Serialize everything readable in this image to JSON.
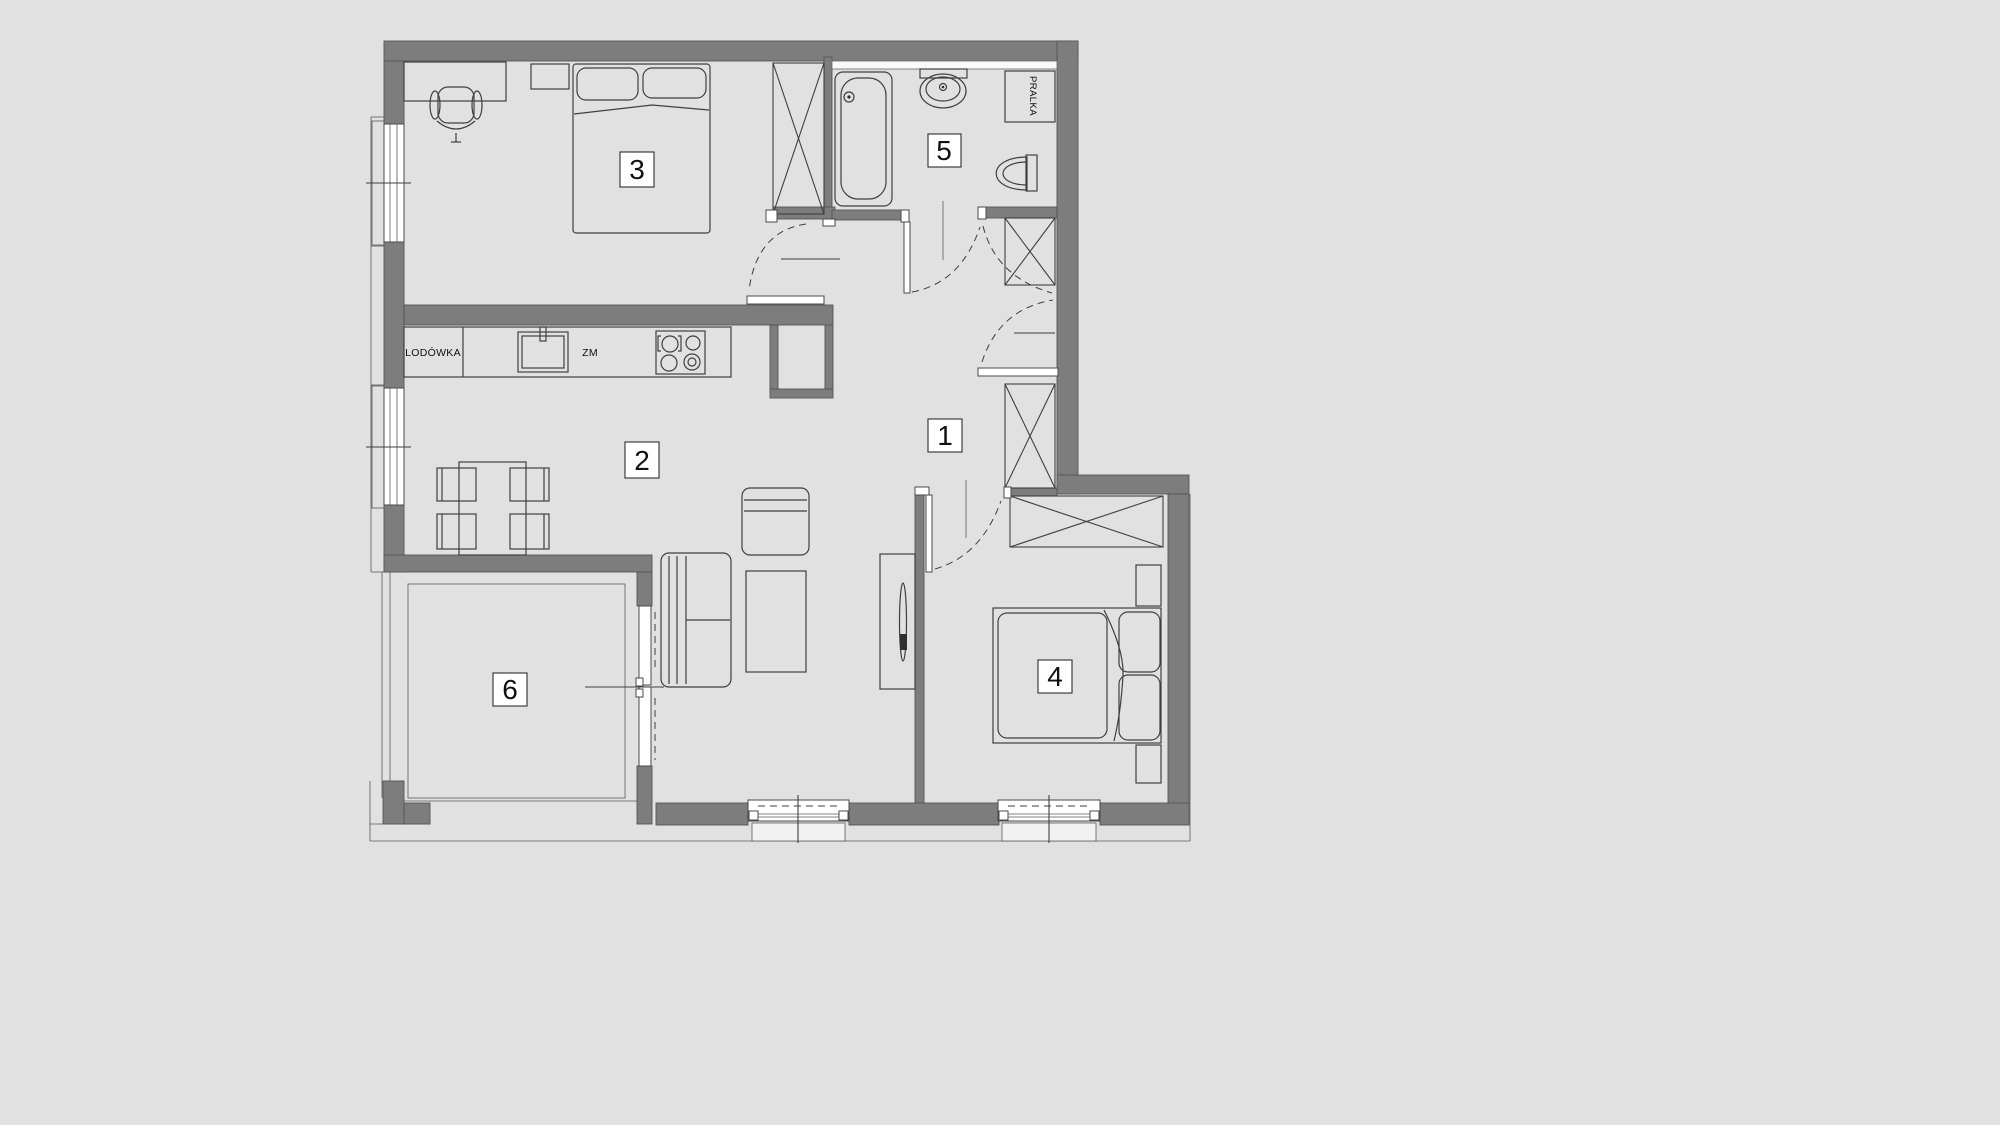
{
  "title": "Apartment floor plan",
  "rooms": [
    {
      "number": "1"
    },
    {
      "number": "2"
    },
    {
      "number": "3"
    },
    {
      "number": "4"
    },
    {
      "number": "5"
    },
    {
      "number": "6"
    }
  ],
  "annotations": {
    "fridge": "LODÓWKA",
    "sink": "ZM",
    "washer": "PRALKA"
  },
  "colors": {
    "background": "#e1e1e1",
    "wall": "#7d7d7d",
    "line": "#3f3f3f",
    "accent_white": "#ffffff"
  }
}
